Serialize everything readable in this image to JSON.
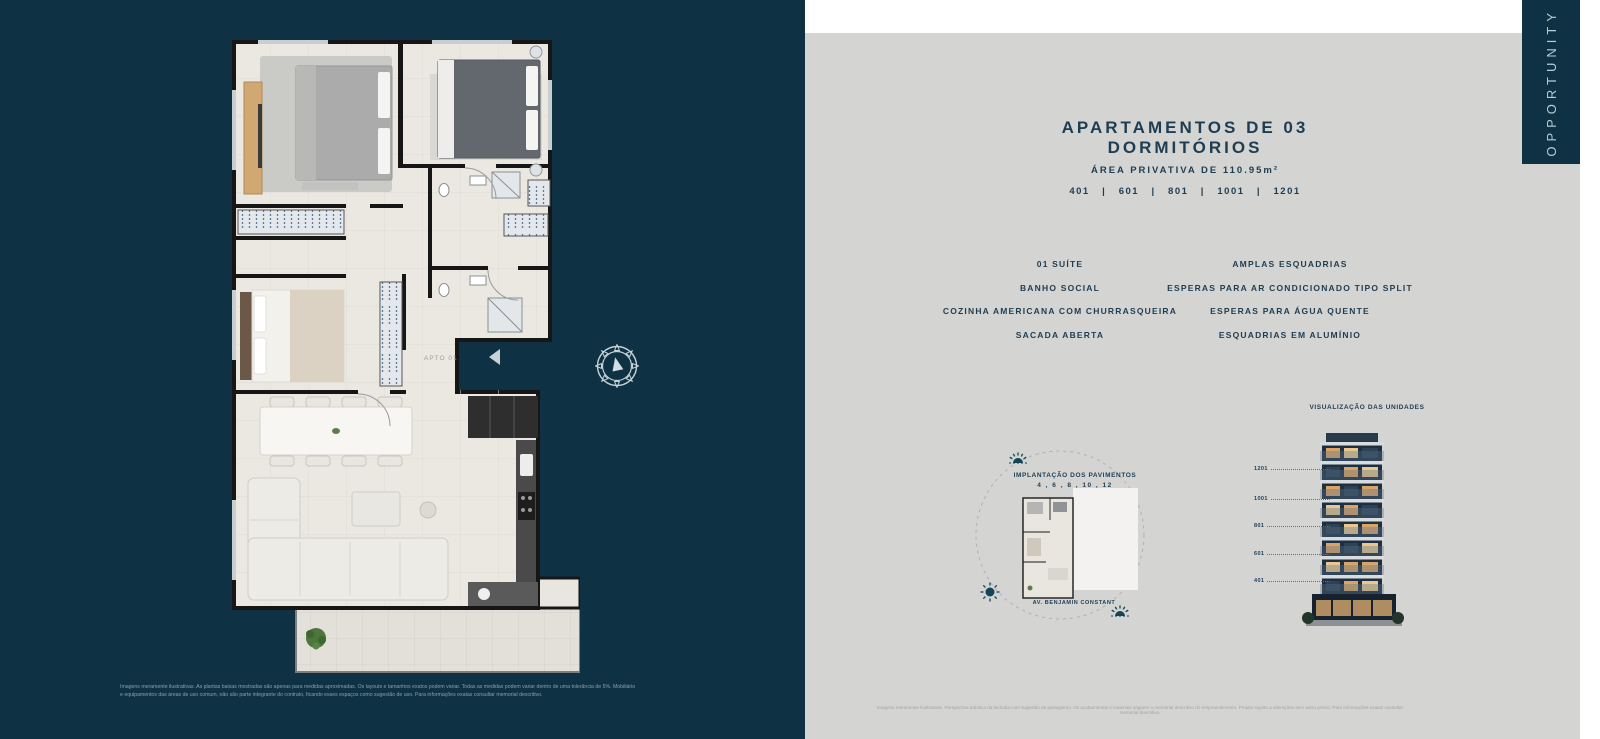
{
  "colors": {
    "panel_dark": "#0e3243",
    "panel_gray": "#d4d4d2",
    "text_navy": "#1e3d52",
    "accent_light": "#b6ccd6",
    "sun_icon": "#12455a",
    "window_warm": "#d9a468"
  },
  "brand": {
    "vertical_label": "OPPORTUNITY"
  },
  "left_panel": {
    "plan_label": "APTO 01",
    "disclaimer_line1": "Imagens meramente ilustrativas. As plantas baixas mostradas são apenas para medidas aproximadas. Os layouts e tamanhos exatos podem variar. Todas as medidas podem variar dentro de uma tolerância de 5%. Mobiliário",
    "disclaimer_line2": "e equipamentos das áreas de uso comum, não são parte integrante do contrato, ficando esses espaços como sugestão de uso. Para informações exatas consultar memorial descritivo."
  },
  "right_panel": {
    "title": "APARTAMENTOS DE 03 DORMITÓRIOS",
    "subtitle": "ÁREA PRIVATIVA DE 110.95m²",
    "units_line": "401   |   601   |   801   |   1001   |   1201",
    "features_left": [
      "01 SUÍTE",
      "BANHO SOCIAL",
      "COZINHA AMERICANA COM CHURRASQUEIRA",
      "SACADA ABERTA"
    ],
    "features_right": [
      "AMPLAS ESQUADRIAS",
      "ESPERAS PARA AR CONDICIONADO TIPO SPLIT",
      "ESPERAS PARA ÁGUA QUENTE",
      "ESQUADRIAS EM ALUMÍNIO"
    ],
    "implantacao": {
      "title": "IMPLANTAÇÃO DOS PAVIMENTOS",
      "floors": "4 , 6 , 8 , 10 , 12",
      "street": "AV. BENJAMIN CONSTANT"
    },
    "visualizacao": {
      "title": "VISUALIZAÇÃO DAS UNIDADES",
      "units": [
        "1201",
        "1001",
        "801",
        "601",
        "401"
      ]
    },
    "disclaimer": "Imagens meramente ilustrativas. Perspectiva artística da fachada com sugestão de paisagismo. Os acabamentos e materiais seguem o memorial descritivo do empreendimento. Projeto sujeito a alterações sem aviso prévio. Para informações exatas consultar memorial descritivo."
  }
}
